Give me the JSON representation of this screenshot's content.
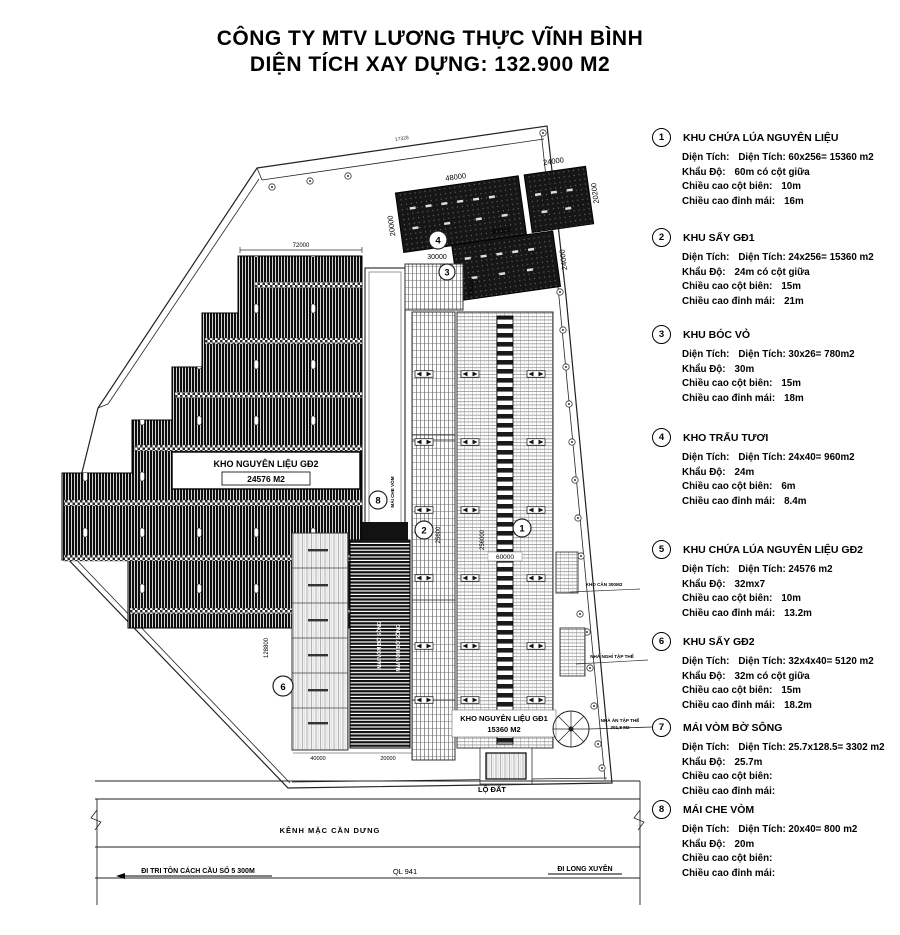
{
  "title": {
    "line1": "CÔNG TY MTV LƯƠNG THỰC VĨNH BÌNH",
    "line2": "DIỆN TÍCH XAY DỰNG: 132.900 M2"
  },
  "plan": {
    "labels": {
      "kho_gd2_1": "KHO NGUYÊN LIỆU GĐ2",
      "kho_gd2_2": "24576 M2",
      "kho_gd1_1": "KHO NGUYÊN LIỆU GĐ1",
      "kho_gd1_2": "15360 M2",
      "kho_can": "KHO CÂN 300M2",
      "nha_nghi": "NHÀ NGHỈ TẬP THỂ",
      "nha_an_1": "NHÀ ĂN TẬP THỂ",
      "nha_an_2": "301,8 M2",
      "mai_che_vom": "MÁI CHE VÒM",
      "mai_vom_bo_song": "MÁI VÒM BỜ SÔNG",
      "lo_dat": "LỘ ĐẤT",
      "kenh": "KÊNH MẶC CẦN DƯNG",
      "tri_ton": "ĐI TRI TÔN CÁCH CẦU SỐ 5 300M",
      "ql941": "QL 941",
      "long_xuyen": "ĐI LONG XUYÊN"
    },
    "dims": {
      "d17328": "17328",
      "d48000": "48000",
      "d24000a": "24000",
      "d20000a": "20000",
      "d20200": "20200",
      "d40000a": "40000",
      "d24000b": "24000",
      "d30000": "30000",
      "d26100": "26100",
      "d72000": "72000",
      "d128800": "128800",
      "d25600": "25600",
      "d256000": "256000",
      "d60000": "60000",
      "d40000b": "40000",
      "d20000b": "20000"
    },
    "bubbles": {
      "n1": "1",
      "n2": "2",
      "n3": "3",
      "n4": "4",
      "n6": "6",
      "n8": "8"
    }
  },
  "legend": {
    "items": [
      {
        "num": "1",
        "name": "KHU CHỨA LÚA NGUYÊN LIỆU",
        "area_label": "Diện Tích:",
        "area": "Diện Tích: 60x256= 15360 m2",
        "span_label": "Khẩu Độ:",
        "span": "60m có cột giữa",
        "edge_label": "Chiều cao cột biên:",
        "edge": "10m",
        "ridge_label": "Chiều cao đỉnh mái:",
        "ridge": "16m"
      },
      {
        "num": "2",
        "name": "KHU SẤY GĐ1",
        "area_label": "Diện Tích:",
        "area": "Diện Tích: 24x256= 15360 m2",
        "span_label": "Khẩu Độ:",
        "span": "24m có cột giữa",
        "edge_label": "Chiều cao cột biên:",
        "edge": "15m",
        "ridge_label": "Chiều cao đỉnh mái:",
        "ridge": "21m"
      },
      {
        "num": "3",
        "name": "KHU BÓC VỎ",
        "area_label": "Diện Tích:",
        "area": "Diện Tích: 30x26= 780m2",
        "span_label": "Khẩu Độ:",
        "span": "30m",
        "edge_label": "Chiều cao cột biên:",
        "edge": "15m",
        "ridge_label": "Chiều cao đỉnh mái:",
        "ridge": "18m"
      },
      {
        "num": "4",
        "name": "KHO TRẤU TƯƠI",
        "area_label": "Diện Tích:",
        "area": "Diện Tích: 24x40= 960m2",
        "span_label": "Khẩu Độ:",
        "span": "24m",
        "edge_label": "Chiều cao cột biên:",
        "edge": "6m",
        "ridge_label": "Chiều cao đỉnh mái:",
        "ridge": "8.4m"
      },
      {
        "num": "5",
        "name": "KHU CHỨA LÚA NGUYÊN LIỆU GĐ2",
        "area_label": "Diện Tích:",
        "area": "Diện Tích: 24576 m2",
        "span_label": "Khẩu Độ:",
        "span": "32mx7",
        "edge_label": "Chiều cao cột biên:",
        "edge": "10m",
        "ridge_label": "Chiều cao đỉnh mái:",
        "ridge": "13.2m"
      },
      {
        "num": "6",
        "name": "KHU SẤY GĐ2",
        "area_label": "Diện Tích:",
        "area": "Diện Tích: 32x4x40= 5120 m2",
        "span_label": "Khẩu Độ:",
        "span": "32m có cột giữa",
        "edge_label": "Chiều cao cột biên:",
        "edge": "15m",
        "ridge_label": "Chiều cao đỉnh mái:",
        "ridge": "18.2m"
      },
      {
        "num": "7",
        "name": "MÁI VÒM BỜ SÔNG",
        "area_label": "Diện Tích:",
        "area": "Diện Tích: 25.7x128.5= 3302 m2",
        "span_label": "Khẩu Độ:",
        "span": "25.7m",
        "edge_label": "Chiều cao cột biên:",
        "edge": "",
        "ridge_label": "Chiều cao đỉnh mái:",
        "ridge": ""
      },
      {
        "num": "8",
        "name": "MÁI CHE VÒM",
        "area_label": "Diện Tích:",
        "area": "Diện Tích: 20x40= 800 m2",
        "span_label": "Khẩu Độ:",
        "span": "20m",
        "edge_label": "Chiều cao cột biên:",
        "edge": "",
        "ridge_label": "Chiều cao đỉnh mái:",
        "ridge": ""
      }
    ]
  }
}
